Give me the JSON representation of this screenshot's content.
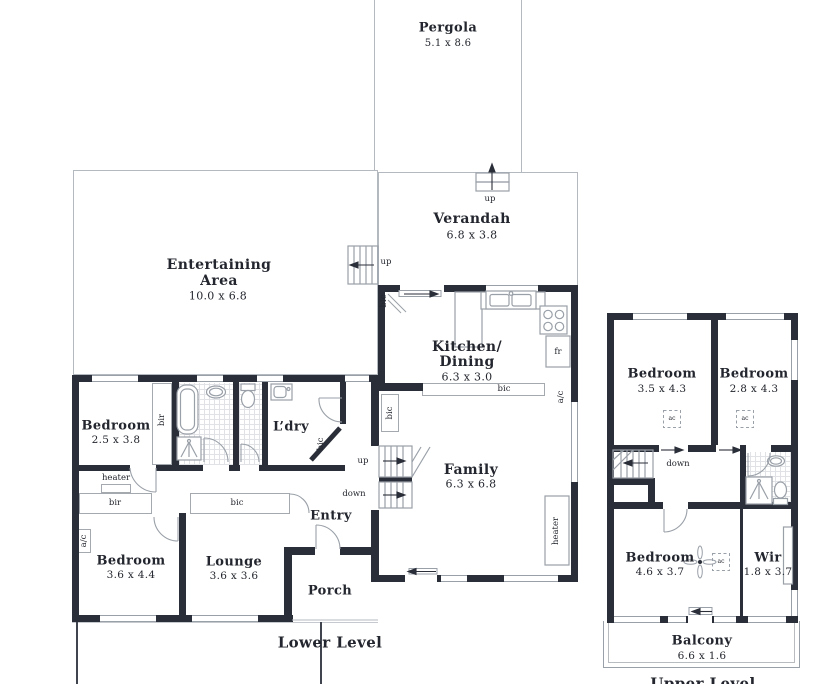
{
  "colors": {
    "wall": "#2a2e38",
    "line": "#9aa0a8",
    "text": "#23262e",
    "background": "#ffffff"
  },
  "plan": {
    "lower_level": {
      "label": "Lower Level",
      "rooms": {
        "pergola": {
          "name": "Pergola",
          "dims": "5.1 x 8.6"
        },
        "verandah": {
          "name": "Verandah",
          "dims": "6.8 x 3.8"
        },
        "entertaining": {
          "name_line1": "Entertaining",
          "name_line2": "Area",
          "dims": "10.0 x 6.8"
        },
        "kitchen_dining": {
          "name_line1": "Kitchen/",
          "name_line2": "Dining",
          "dims": "6.3 x 3.0"
        },
        "family": {
          "name": "Family",
          "dims": "6.3 x 6.8"
        },
        "bedroom_front": {
          "name": "Bedroom",
          "dims": "2.5 x 3.8"
        },
        "laundry": {
          "name": "L’dry"
        },
        "entry": {
          "name": "Entry"
        },
        "bedroom_rear": {
          "name": "Bedroom",
          "dims": "3.6 x 4.4"
        },
        "lounge": {
          "name": "Lounge",
          "dims": "3.6 x 3.6"
        },
        "porch": {
          "name": "Porch"
        }
      }
    },
    "upper_level": {
      "label": "Upper Level",
      "rooms": {
        "bedroom_left": {
          "name": "Bedroom",
          "dims": "3.5 x 4.3"
        },
        "bedroom_right": {
          "name": "Bedroom",
          "dims": "2.8 x 4.3"
        },
        "bedroom_main": {
          "name": "Bedroom",
          "dims": "4.6 x 3.7"
        },
        "wir": {
          "name": "Wir",
          "dims": "1.8 x 3.7"
        },
        "balcony": {
          "name": "Balcony",
          "dims": "6.6 x 1.6"
        }
      }
    }
  },
  "tags": {
    "up": "up",
    "down": "down",
    "bir": "bir",
    "bic": "bic",
    "heater": "heater",
    "ac": "a/c",
    "ac_unit": "ac",
    "fridge": "fr"
  }
}
